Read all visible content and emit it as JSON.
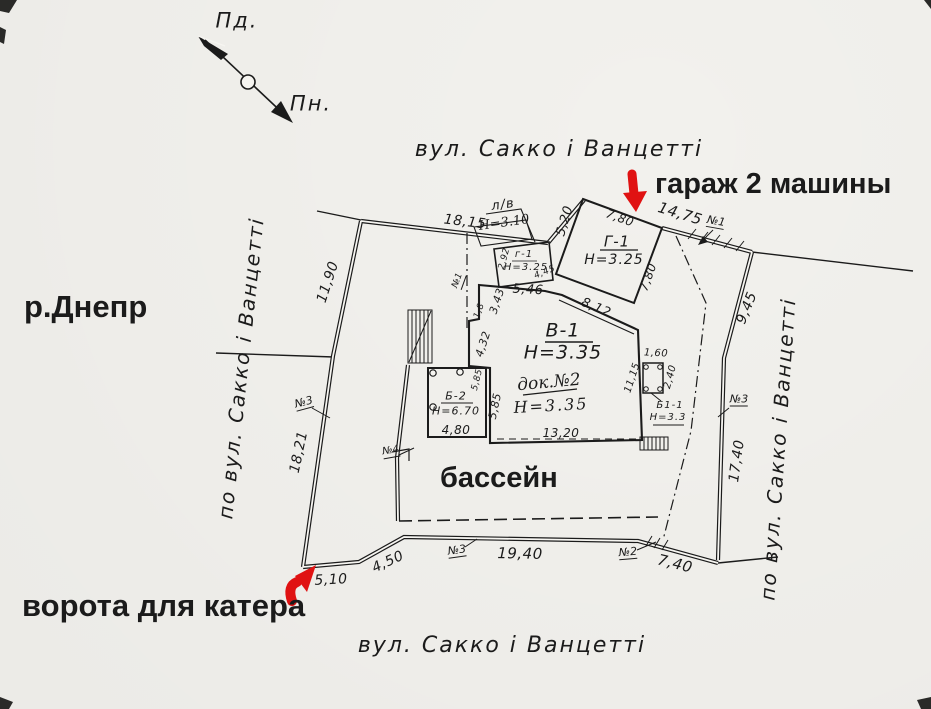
{
  "compass": {
    "south_label": "Пд.",
    "north_label": "Пн."
  },
  "streets": {
    "top": "вул. Сакко і Ванцетті",
    "bottom": "вул. Сакко і Ванцетті",
    "left": "по вул. Сакко і Ванцетті",
    "right": "по вул. Сакко і Ванцетті"
  },
  "annotations": {
    "river": "р.Днепр",
    "garage": "гараж 2 машины",
    "pool": "бассейн",
    "gate": "ворота для катера"
  },
  "colors": {
    "ink": "#1b1b1b",
    "accent_red": "#e01212",
    "paper": "#f6f5f1"
  },
  "buildings": {
    "garage_g1": {
      "label": "Г-1",
      "height": "Н=3.25"
    },
    "annex_g1": {
      "label": "г-1",
      "height": "Н=3.25"
    },
    "shed_lv": {
      "label": "л/в",
      "height": "Н=3.10"
    },
    "house_v1": {
      "label": "В-1",
      "height": "Н=3.35"
    },
    "block_b2": {
      "label": "Б-2",
      "height": "Н=6.70"
    },
    "block_b1_1": {
      "label": "Б1-1",
      "height": "Н=3.3"
    },
    "note_dock": {
      "label": "док.№2",
      "height": "Н=3.35"
    }
  },
  "dimensions": {
    "top_fence": "18,15",
    "garage_setback": "5,20",
    "garage_front": "7,80",
    "street_fence_right": "14,75",
    "garage_side": "7,80",
    "left_upper": "11,90",
    "left_lower": "18,21",
    "right_upper": "9,45",
    "right_lower": "17,40",
    "bottom_gate": "5,10",
    "bottom_slope": "4,50",
    "bottom_fence": "19,40",
    "bottom_right": "7,40",
    "house_top": "5,46",
    "house_diag": "8,12",
    "house_left_step": "3,43",
    "annex_side": "2,92",
    "annex_diag": "4,45",
    "house_left_mid": "4,32",
    "house_left_small": "1,8",
    "b2_side_a": "5,85",
    "b2_side_b": "5,85",
    "house_bottom": "13,20",
    "b2_width": "4,80",
    "b1_width": "1,60",
    "b1_height": "2,40",
    "b1_offset": "11,15"
  },
  "markers": {
    "fence1_top": "№1",
    "fence1_mid": "№1",
    "fence3_left": "№3",
    "fence3_right": "№3",
    "fence3_bottom": "№3",
    "fence2_bottom": "№2",
    "fence4_left": "№4"
  }
}
